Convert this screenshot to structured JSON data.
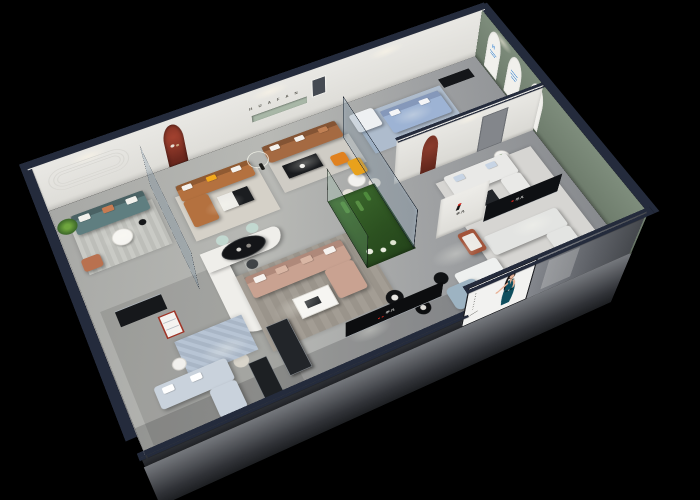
{
  "background": "#000000",
  "brand": {
    "name_cn": "华凡",
    "mark_letter": "H",
    "back_wall_letters": "H U A F A N"
  },
  "signs": {
    "arch_panel_logo": "H",
    "arch_panel_count": 3,
    "column_logo_text": "华凡",
    "reception_logo_text": "华凡",
    "media_wall_logo_text": "华凡"
  },
  "poster": {
    "subject": "model in dark teal dress on white backdrop",
    "vertical_marks_count": 7,
    "dress_color": "#0e4e5e"
  },
  "palette": {
    "wall_cap_navy": "#242b3c",
    "interior_wall": "#e9e8e4",
    "sage_wall": "#7e8d7c",
    "floor_gray": "#b4b5b2",
    "accent_red": "#a03527",
    "logo_red": "#d8261c",
    "logo_blue": "#2e7fd2",
    "teal_sofa": "#5f7e80",
    "caramel_sofa": "#b4713f",
    "brown_sofa": "#a56a42",
    "blush_sofa": "#c9a291",
    "blue_sofa": "#9db3d4",
    "accent_orange": "#e0811f",
    "poster_dress": "#0e4e5e",
    "plant_green": "#4e7d3a"
  }
}
